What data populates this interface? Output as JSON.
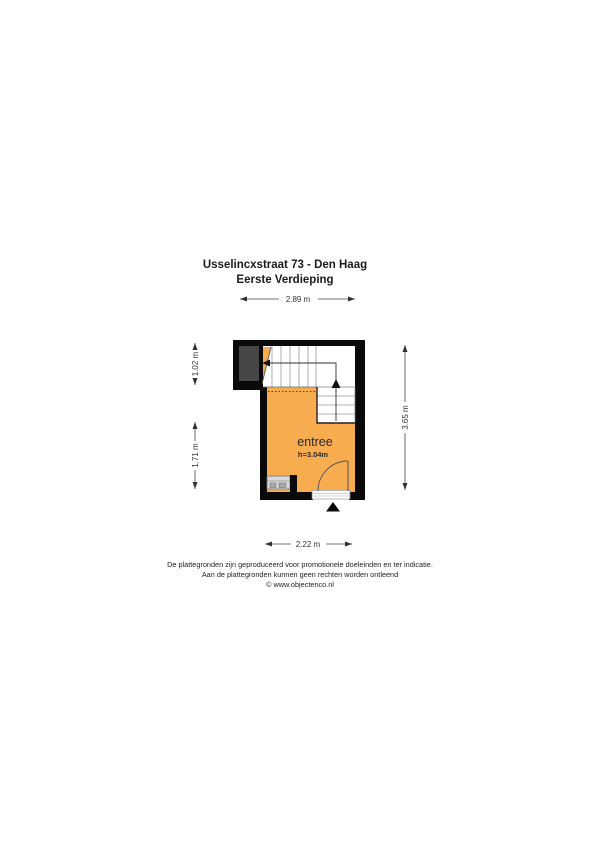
{
  "title": {
    "line1": "Usselincxstraat 73 - Den Haag",
    "line2": "Eerste Verdieping"
  },
  "floorplan": {
    "room": {
      "name": "entree",
      "ceiling_height": "h=3.04m"
    },
    "dimensions": {
      "top": "2.89 m",
      "bottom": "2.22 m",
      "left_upper": "1.02 m",
      "left_lower": "1.71 m",
      "right": "3.65 m"
    },
    "colors": {
      "room_fill": "#F7AC50",
      "void_fill": "#464646",
      "wall": "#0A0A0A"
    }
  },
  "footer": {
    "line1": "De plattegronden zijn geproduceerd voor promotionele doeleinden en ter indicatie.",
    "line2": "Aan de plattegronden kunnen geen rechten worden ontleend",
    "line3": "© www.objectenco.nl"
  }
}
